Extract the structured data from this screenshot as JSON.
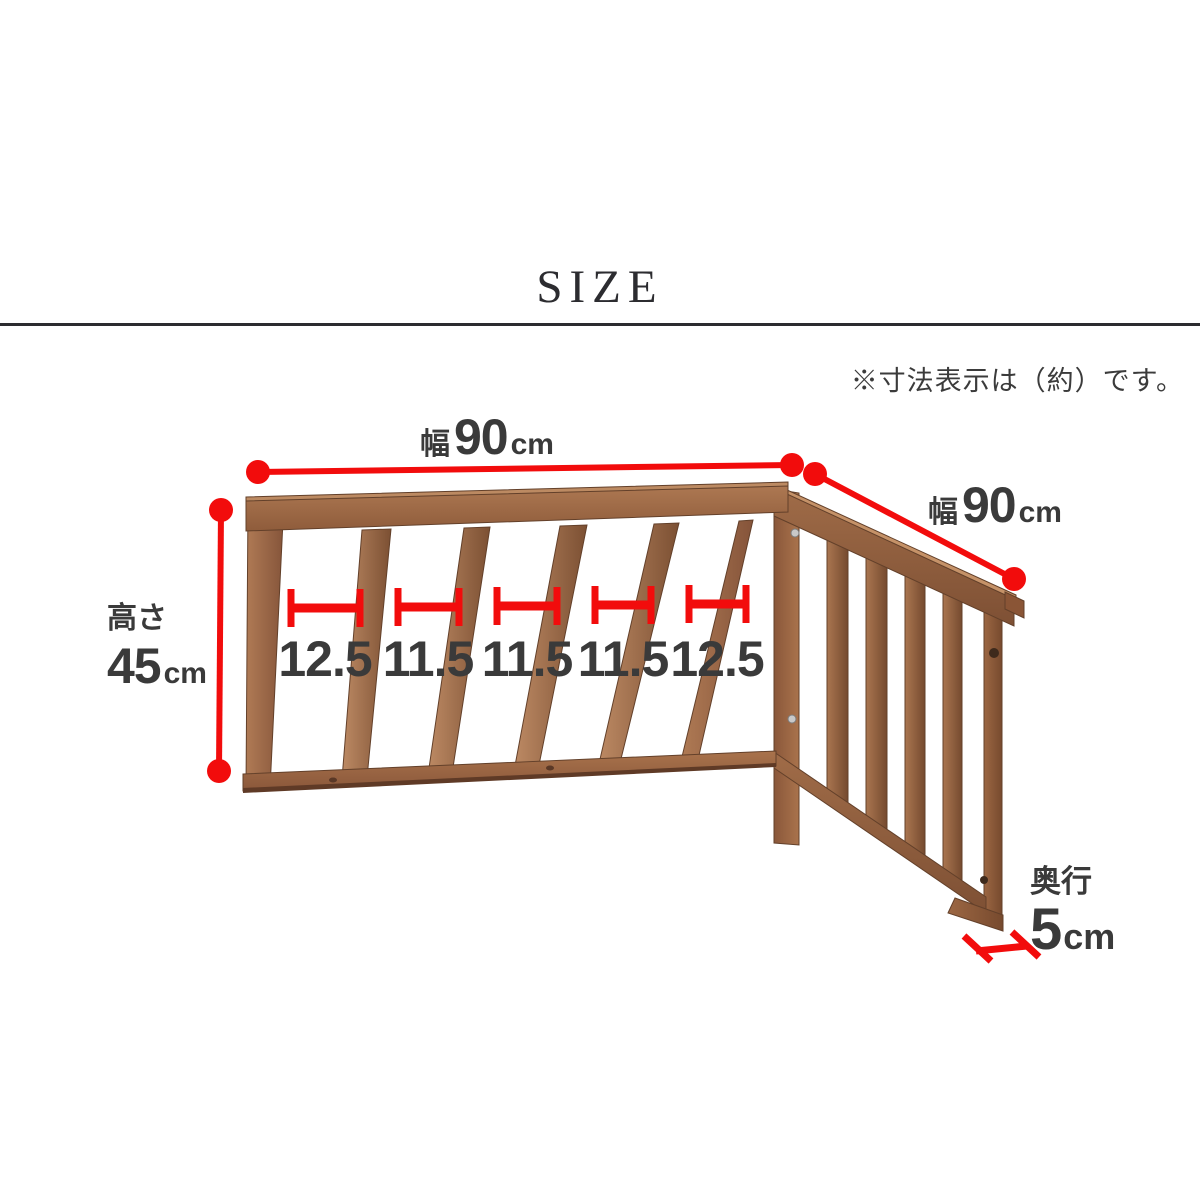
{
  "page": {
    "title": "SIZE",
    "note": "※寸法表示は（約）です。"
  },
  "labels": {
    "width_top": {
      "prefix": "幅",
      "value": "90",
      "unit": "cm"
    },
    "width_side": {
      "prefix": "幅",
      "value": "90",
      "unit": "cm"
    },
    "height": {
      "prefix": "高さ",
      "value": "45",
      "unit": "cm"
    },
    "depth": {
      "prefix": "奥行",
      "value": "5",
      "unit": "cm"
    },
    "gaps": [
      "12.5",
      "11.5",
      "11.5",
      "11.5",
      "12.5"
    ]
  },
  "colors": {
    "dimension_red": "#f20c0c",
    "label_text": "#3a3a3a",
    "rule": "#2c2c30",
    "wood_light": "#bd8a64",
    "wood_dark": "#7c5033"
  },
  "illustration": "l-shaped-wooden-corner-fence-two-panels"
}
